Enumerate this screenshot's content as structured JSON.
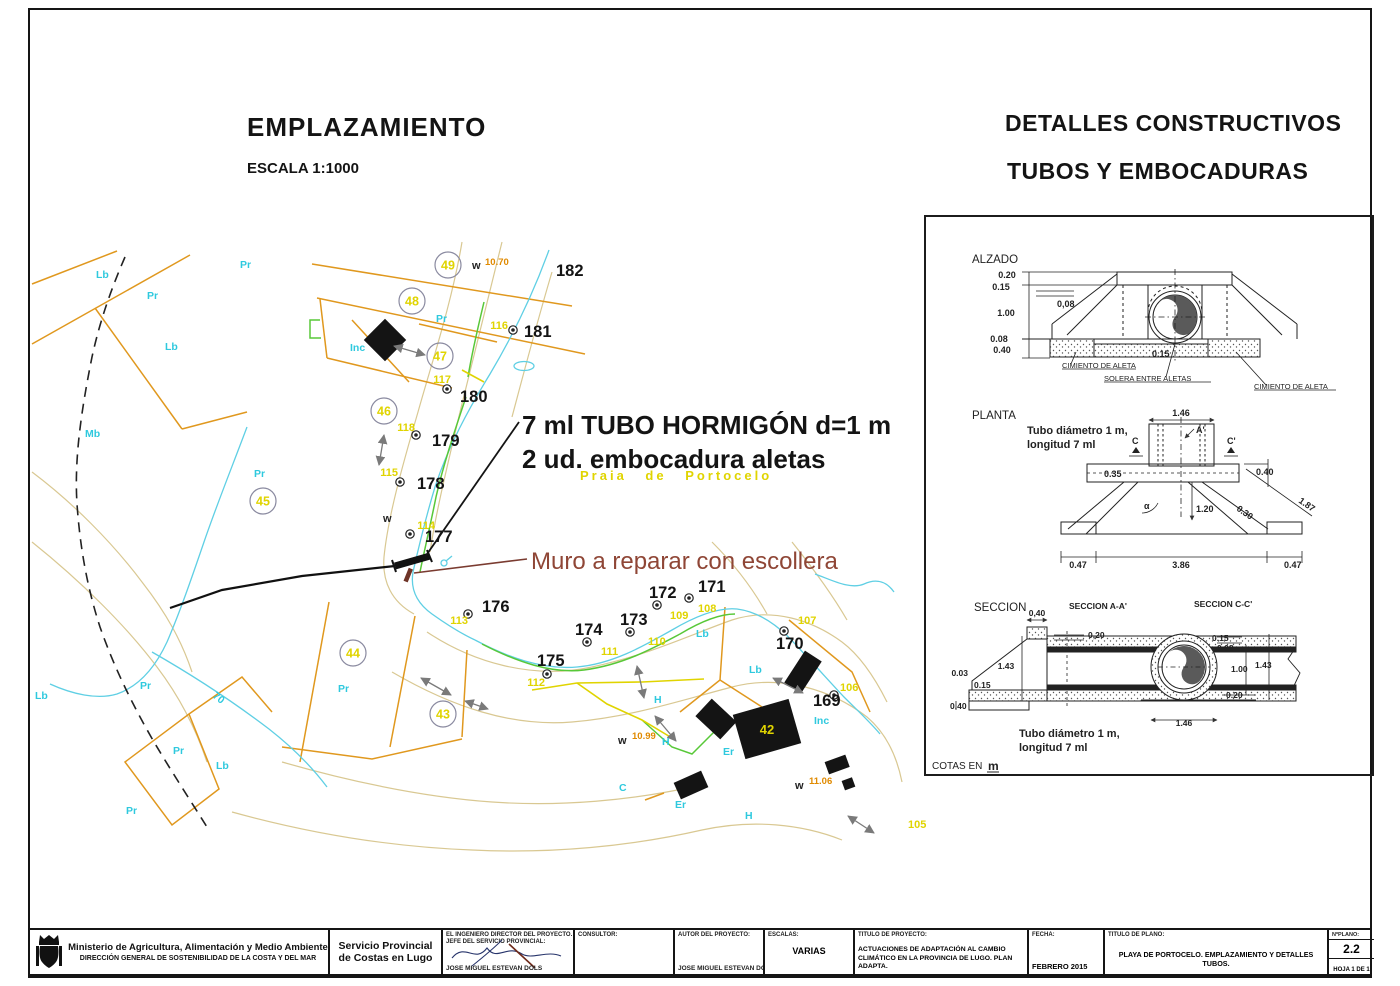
{
  "header": {
    "left_title": "EMPLAZAMIENTO",
    "left_scale": "ESCALA 1:1000",
    "right_title1": "DETALLES CONSTRUCTIVOS",
    "right_title2": "TUBOS Y EMBOCADURAS"
  },
  "map": {
    "tube_note": [
      "7 ml TUBO HORMIGÓN d=1 m",
      "2 ud. embocadura aletas"
    ],
    "muro_note": "Muro a reparar con escollera",
    "beach": "Praia de Portocelo",
    "plots": [
      "49",
      "48",
      "47",
      "46",
      "45",
      "44",
      "43",
      "42"
    ],
    "points": [
      {
        "n": "182",
        "id": ""
      },
      {
        "n": "181",
        "id": "116"
      },
      {
        "n": "180",
        "id": "117"
      },
      {
        "n": "179",
        "id": "118"
      },
      {
        "n": "178",
        "id": "115"
      },
      {
        "n": "177",
        "id": "114"
      },
      {
        "n": "176",
        "id": "113"
      },
      {
        "n": "175",
        "id": "112"
      },
      {
        "n": "174",
        "id": "111"
      },
      {
        "n": "173",
        "id": "110"
      },
      {
        "n": "172",
        "id": "109"
      },
      {
        "n": "171",
        "id": "108"
      },
      {
        "n": "170",
        "id": "107"
      },
      {
        "n": "169",
        "id": "106"
      }
    ],
    "extra_id": "105",
    "codes": {
      "lb": "Lb",
      "pr": "Pr",
      "mb": "Mb",
      "inc": "Inc",
      "h": "H",
      "er": "Er",
      "c": "C",
      "s70": "70",
      "w": "w"
    },
    "elevations": [
      "10.70",
      "10.99",
      "11.06"
    ],
    "colors": {
      "boundary": "#e0981e",
      "contour": "#d9c892",
      "water": "#5fcfe4",
      "vegetation": "#58c838",
      "survey_yellow": "#e0d400",
      "muro_text": "#8f4636",
      "elevation_orange": "#e08a00"
    }
  },
  "details": {
    "alzado": {
      "title": "ALZADO",
      "d020": "0.20",
      "d015a": "0.15",
      "d008c": "0,08",
      "d100": "1.00",
      "d008": "0.08",
      "d040": "0.40",
      "d015b": "0.15",
      "lbl_cim_left": "CIMIENTO DE ALETA",
      "lbl_solera": "SOLERA ENTRE ALETAS",
      "lbl_cim_right": "CIMIENTO DE ALETA"
    },
    "planta": {
      "title": "PLANTA",
      "note1": "Tubo diámetro 1 m,",
      "note2": "longitud 7 ml",
      "d146": "1.46",
      "d035": "0.35",
      "d040": "0.40",
      "d187": "1.87",
      "d030": "0.30",
      "d120": "1.20",
      "d047a": "0.47",
      "d386": "3.86",
      "d047b": "0.47",
      "mC": "C",
      "mA": "A'",
      "mC2": "C'",
      "alpha": "α"
    },
    "seccion": {
      "title": "SECCION",
      "aa": "SECCION A-A'",
      "cc": "SECCION C-C'",
      "note1": "Tubo diámetro 1 m,",
      "note2": "longitud 7 ml",
      "a_d040t": "0,40",
      "a_d020": "0,20",
      "a_d143": "1.43",
      "a_d003": "0.03",
      "a_d015": "0.15",
      "a_d040b": "0.40",
      "c_d015": "0.15",
      "c_d008": "0.08",
      "c_d100": "1.00",
      "c_d143": "1.43",
      "c_d020": "0.20",
      "c_d146": "1.46"
    },
    "cotas": "COTAS EN",
    "cotas_unit": "m"
  },
  "titleblock": {
    "ministry_line1": "Ministerio de Agricultura, Alimentación y Medio Ambiente",
    "ministry_line2": "DIRECCIÓN GENERAL DE SOSTENIBILIDAD DE LA COSTA Y DEL MAR",
    "service_line1": "Servicio Provincial",
    "service_line2": "de Costas en Lugo",
    "director_label1": "EL INGENIERO DIRECTOR DEL PROYECTO.",
    "director_label2": "JEFE DEL SERVICIO PROVINCIAL:",
    "director_name": "JOSE MIGUEL ESTEVAN DOLS",
    "consultor_label": "CONSULTOR:",
    "autor_label": "AUTOR DEL PROYECTO:",
    "autor_name": "JOSE MIGUEL ESTEVAN DOLS",
    "escalas_label": "ESCALAS:",
    "escalas_value": "VARIAS",
    "titulo_proyecto_label": "TITULO DE PROYECTO:",
    "titulo_proyecto_line1": "ACTUACIONES DE ADAPTACIÓN AL CAMBIO",
    "titulo_proyecto_line2": "CLIMÁTICO EN LA PROVINCIA DE LUGO. PLAN ADAPTA.",
    "fecha_label": "FECHA:",
    "fecha_value": "FEBRERO 2015",
    "titulo_plano_label": "TITULO DE PLANO:",
    "titulo_plano_value": "PLAYA DE PORTOCELO. EMPLAZAMIENTO Y DETALLES TUBOS.",
    "num_label": "NºPLANO:",
    "num_value": "2.2",
    "hoja_value": "HOJA 1 DE 1"
  }
}
